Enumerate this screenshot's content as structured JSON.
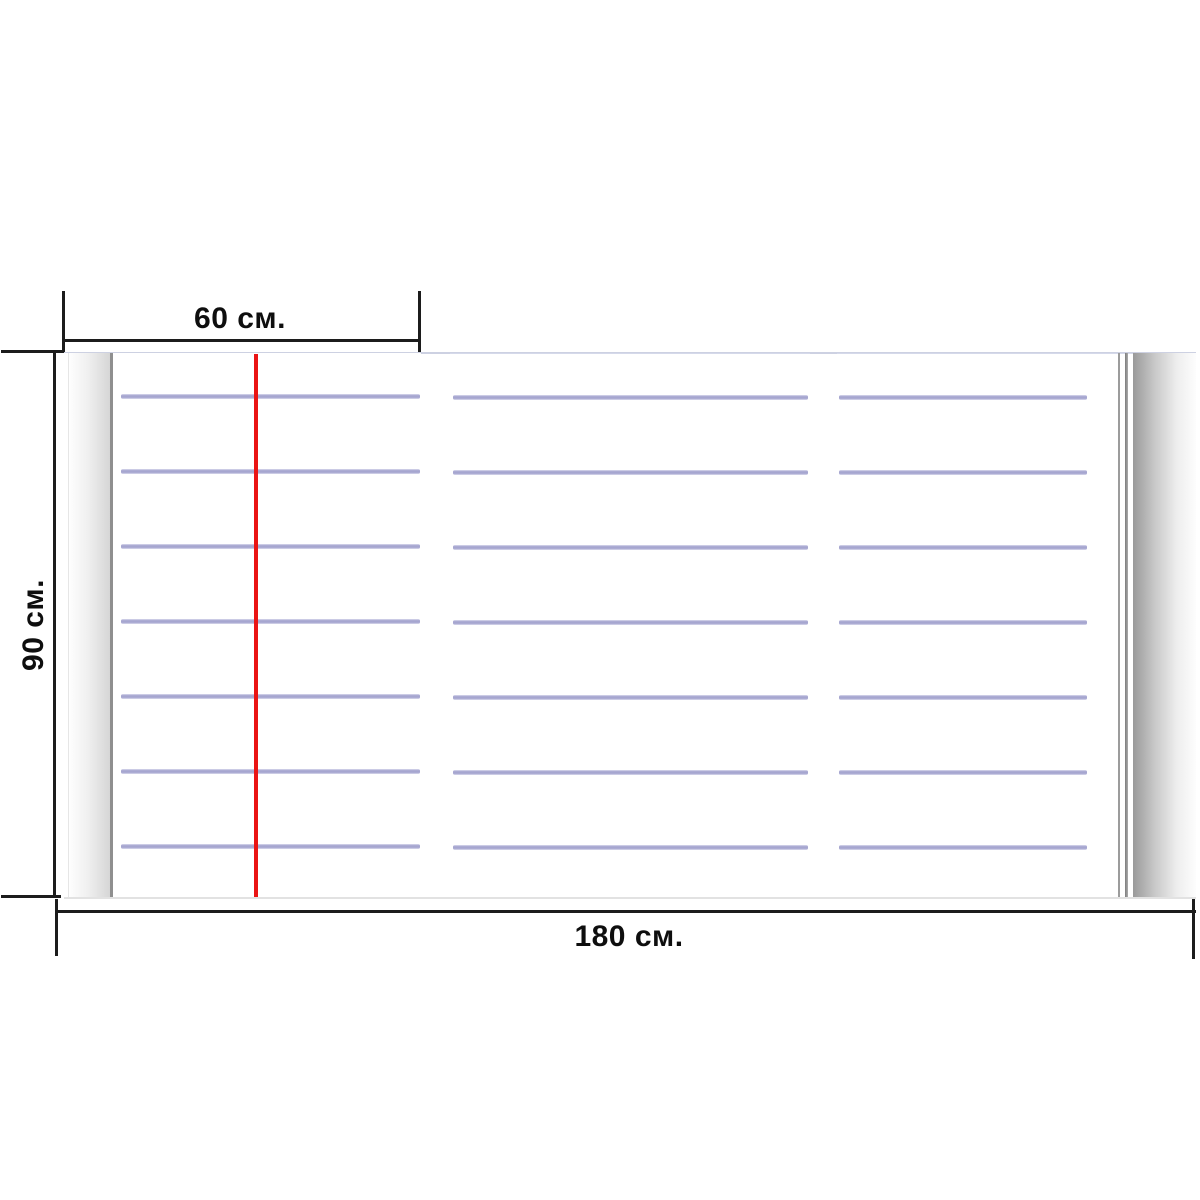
{
  "diagram": {
    "type": "product-dimension-diagram",
    "subject": "lined notebook-sheet board with three ruled panels and red margin line"
  },
  "dimensions": {
    "top": {
      "label": "60 см.",
      "value_cm": 60
    },
    "left": {
      "label": "90 см.",
      "value_cm": 90
    },
    "bottom": {
      "label": "180 см.",
      "value_cm": 180
    }
  },
  "board": {
    "panel_count": 3,
    "ruled_lines_per_panel": 7,
    "has_red_margin_line": true,
    "colors": {
      "ruled_line": "#a6a6d0",
      "ruled_line_edge": "#dcdcee",
      "margin_line": "#ea1414",
      "dimension_line": "#1c1c1c",
      "curl_shadow": "#9a9a9a"
    }
  }
}
